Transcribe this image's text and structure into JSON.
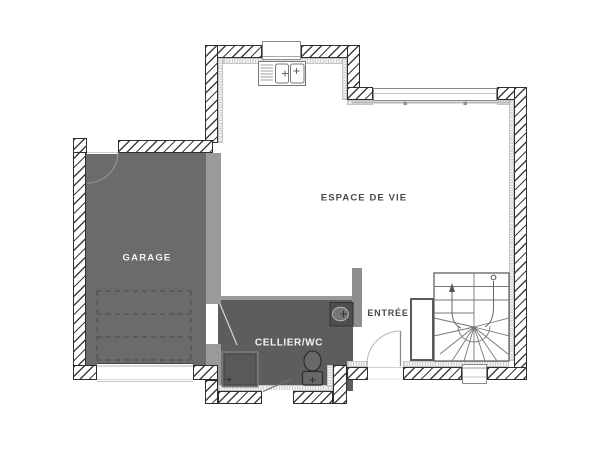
{
  "plan": {
    "type": "floor-plan",
    "labels": {
      "garage": "GARAGE",
      "living": "ESPACE DE VIE",
      "cellier": "CELLIER/WC",
      "entry": "ENTRÉE"
    },
    "fixtures": [
      "kitchen-sink",
      "kitchen-window",
      "bay-window",
      "staircase",
      "wc-toilet",
      "washbasin",
      "utility-unit",
      "garage-sectional-door",
      "garage-service-door",
      "entry-door",
      "cellier-exterior-door",
      "bottom-window"
    ],
    "colors": {
      "background": "#ffffff",
      "wall_hatch": "#3f3f3f",
      "garage_floor": "#6b6b6b",
      "cellier_floor": "#5d5d5d",
      "partition": "#9a9a9a",
      "pillar": "#8e8e8e",
      "insulation": "#cfcfcf",
      "label_dark": "#4a4a4a",
      "label_light": "#f2f2f2"
    }
  }
}
